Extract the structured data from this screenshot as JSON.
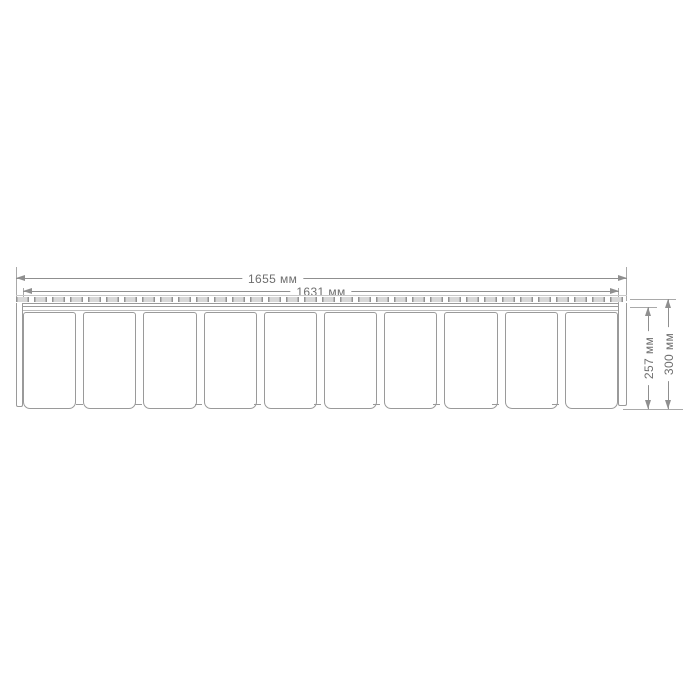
{
  "drawing": {
    "kind": "technical-dimension-drawing",
    "units_suffix": "мм",
    "panel": {
      "plank_count": 10,
      "has_nail_slot_row": true
    },
    "dimensions": {
      "overall_width": {
        "value": 1655,
        "label": "1655 мм",
        "orientation": "horizontal"
      },
      "face_width": {
        "value": 1631,
        "label": "1631 мм",
        "orientation": "horizontal"
      },
      "face_height": {
        "value": 257,
        "label": "257 мм",
        "orientation": "vertical"
      },
      "overall_height": {
        "value": 300,
        "label": "300 мм",
        "orientation": "vertical"
      }
    },
    "colors": {
      "background": "#ffffff",
      "outline": "#9a9a9a",
      "dimension_line": "#8f8f8f",
      "extension_line": "#a9a9a9",
      "slot_fill": "#d8d8d8",
      "text": "#6e6e6e"
    }
  }
}
